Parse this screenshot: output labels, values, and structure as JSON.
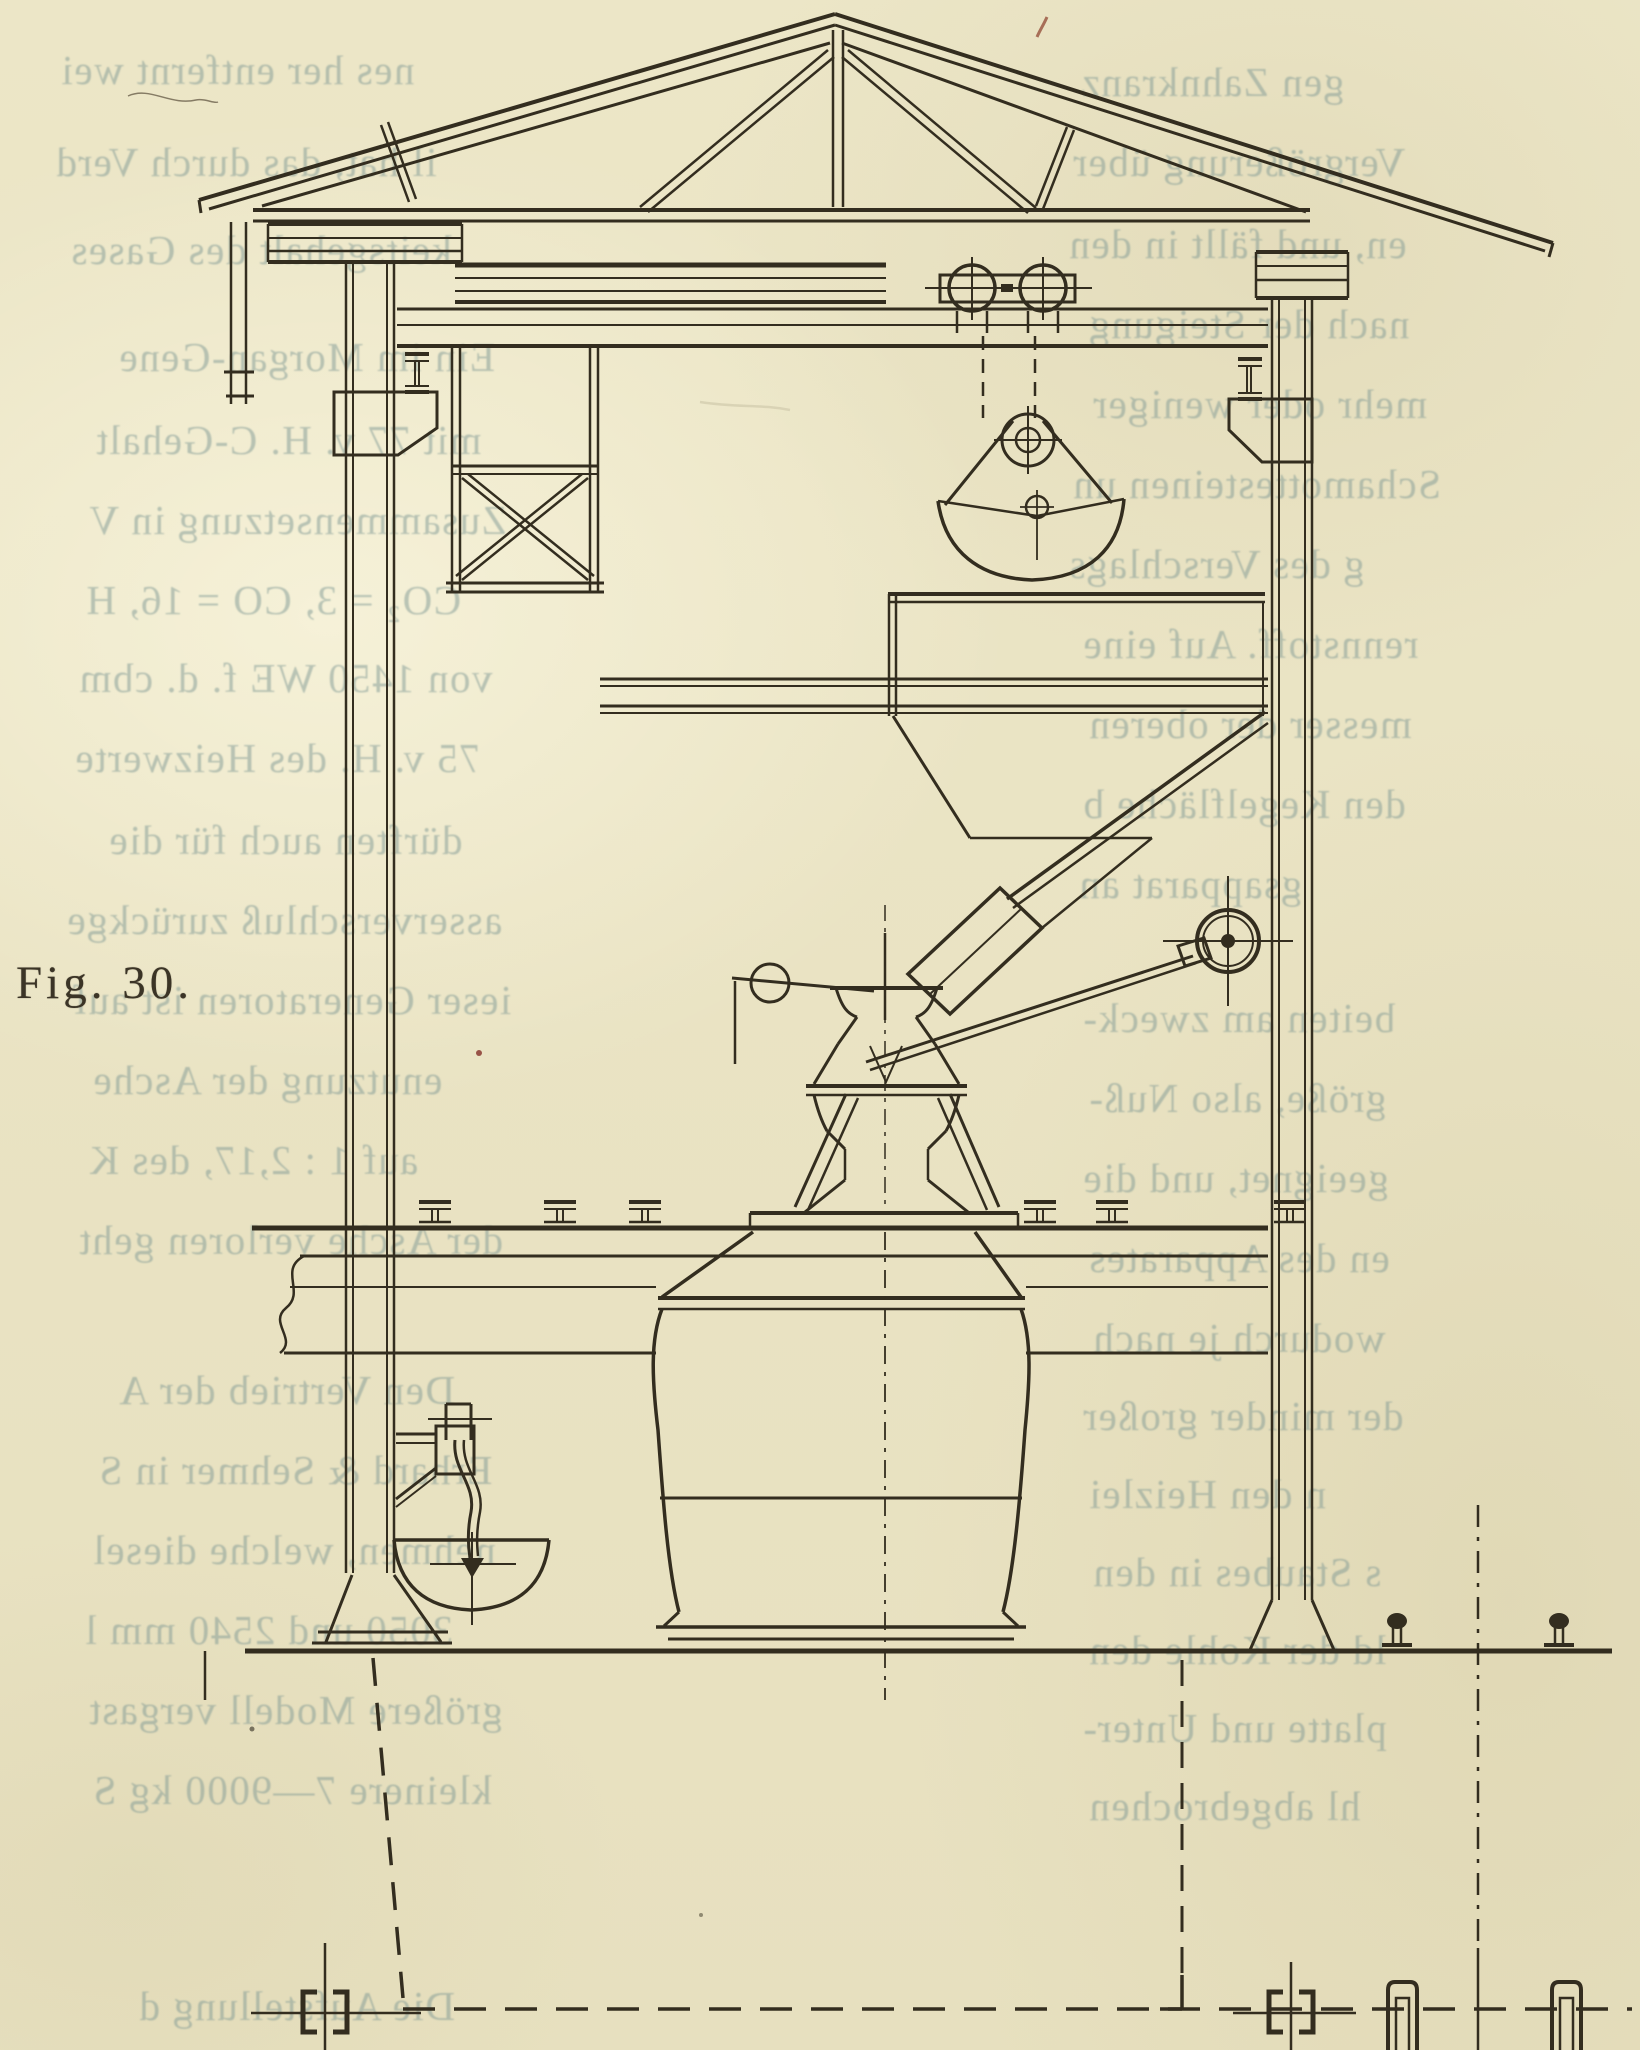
{
  "page": {
    "kind": "scanned antique book page with technical engraving",
    "language": "German",
    "figure_label": "Fig. 30."
  },
  "colors": {
    "paper": "#ebe5c5",
    "ink": "#332d1f",
    "ghost_text": "rgba(126,152,147,0.50)",
    "label_ink": "#3b3426",
    "red_speck": "#8a3a30"
  },
  "figure": {
    "caption": "Fig. 30.",
    "subject": "Cross-section of a generator house: roof truss, crane trolley with grab bucket, coal hopper with chute, charging bell with counterweight and handwheel, generator shaft passing through the charging floor, gas downpipe with water bowl, underground pipe lines with valves",
    "components": [
      "roof-truss",
      "king-post",
      "left-wall-column",
      "right-wall-column",
      "ceiling-tie-beam",
      "crane-runway-girder",
      "platform-deck",
      "hanging-brace-frame",
      "crane-trolley",
      "hoist-ropes",
      "hoist-pulley",
      "grab-bucket",
      "coal-hopper",
      "charging-chute",
      "charging-bell",
      "counterweight-lever",
      "control-rod",
      "handwheel",
      "generator-shaft",
      "charging-floor",
      "floor-rails",
      "gas-downpipe",
      "water-bowl",
      "wall-foundations",
      "ground-line",
      "underground-dashed-lines",
      "valve-symbols",
      "outdoor-rails",
      "pipe-stubs"
    ]
  },
  "ghost_text": {
    "note": "mirrored show-through print from the reverse side of the page",
    "left": [
      {
        "y": 46,
        "x": 60,
        "text": "nes her entfernt wei"
      },
      {
        "y": 138,
        "x": 55,
        "text": "il hat, das durch Verd"
      },
      {
        "y": 226,
        "x": 70,
        "text": "keitsgehalt des Gases"
      },
      {
        "y": 333,
        "x": 118,
        "text": "Ein im Morgan-Gene"
      },
      {
        "y": 416,
        "x": 95,
        "text": "mit 77 v. H. C-Gehalt"
      },
      {
        "y": 496,
        "x": 88,
        "text": "Zusammensetzung in V"
      },
      {
        "y": 576,
        "x": 85,
        "text": "CO₂ = 3, CO = 16, H"
      },
      {
        "y": 654,
        "x": 78,
        "text": "von 1450 WE f. d. cbm"
      },
      {
        "y": 734,
        "x": 74,
        "text": "75 v. H. des Heizwerte"
      },
      {
        "y": 816,
        "x": 108,
        "text": "dürften auch für die"
      },
      {
        "y": 896,
        "x": 66,
        "text": "asserverschluß zurückge"
      },
      {
        "y": 976,
        "x": 72,
        "text": "ieser Generatoren ist auf"
      },
      {
        "y": 1056,
        "x": 92,
        "text": "enutzung der Asche"
      },
      {
        "y": 1136,
        "x": 88,
        "text": "auf 1 : 2,17, des K"
      },
      {
        "y": 1216,
        "x": 78,
        "text": "der Asche verloren geht"
      },
      {
        "y": 1366,
        "x": 118,
        "text": "Den Vertrieb der A"
      },
      {
        "y": 1446,
        "x": 98,
        "text": "Erhard & Sehmer in S"
      },
      {
        "y": 1526,
        "x": 92,
        "text": "nehmen, welche diesel"
      },
      {
        "y": 1606,
        "x": 84,
        "text": "3050 und 2540 mm l"
      },
      {
        "y": 1686,
        "x": 88,
        "text": "größere Modell vergast"
      },
      {
        "y": 1766,
        "x": 92,
        "text": "kleinere 7—9000 kg S"
      },
      {
        "y": 1982,
        "x": 138,
        "text": "Die Aufstellung d"
      }
    ],
    "right": [
      {
        "y": 58,
        "x": 1080,
        "text": "gen Zahnkranz"
      },
      {
        "y": 138,
        "x": 1072,
        "text": "Vergrößerung über"
      },
      {
        "y": 220,
        "x": 1068,
        "text": "en, und fällt in den"
      },
      {
        "y": 300,
        "x": 1088,
        "text": "nach der Steigung"
      },
      {
        "y": 380,
        "x": 1092,
        "text": "mehr oder weniger"
      },
      {
        "y": 460,
        "x": 1072,
        "text": "Schamottesteinen un"
      },
      {
        "y": 540,
        "x": 1068,
        "text": "g des Verschlags"
      },
      {
        "y": 620,
        "x": 1082,
        "text": "rennstoff. Auf eine"
      },
      {
        "y": 700,
        "x": 1088,
        "text": "messer der oberen"
      },
      {
        "y": 780,
        "x": 1082,
        "text": "den Kegelfläche b"
      },
      {
        "y": 860,
        "x": 1078,
        "text": "gsapparat an"
      },
      {
        "y": 994,
        "x": 1082,
        "text": "beiten am zweck-"
      },
      {
        "y": 1074,
        "x": 1088,
        "text": "größe, also Nuß-"
      },
      {
        "y": 1154,
        "x": 1082,
        "text": "geeignet, und die"
      },
      {
        "y": 1234,
        "x": 1088,
        "text": "en des Apparates"
      },
      {
        "y": 1314,
        "x": 1092,
        "text": "wodurch je nach"
      },
      {
        "y": 1392,
        "x": 1082,
        "text": "der minder großer"
      },
      {
        "y": 1470,
        "x": 1088,
        "text": "n den Heizlei"
      },
      {
        "y": 1548,
        "x": 1092,
        "text": "s Staubes in den"
      },
      {
        "y": 1626,
        "x": 1088,
        "text": "ld der Kohle den"
      },
      {
        "y": 1704,
        "x": 1082,
        "text": "platte und Unter-"
      },
      {
        "y": 1782,
        "x": 1088,
        "text": "hl abgebrochen"
      }
    ]
  }
}
